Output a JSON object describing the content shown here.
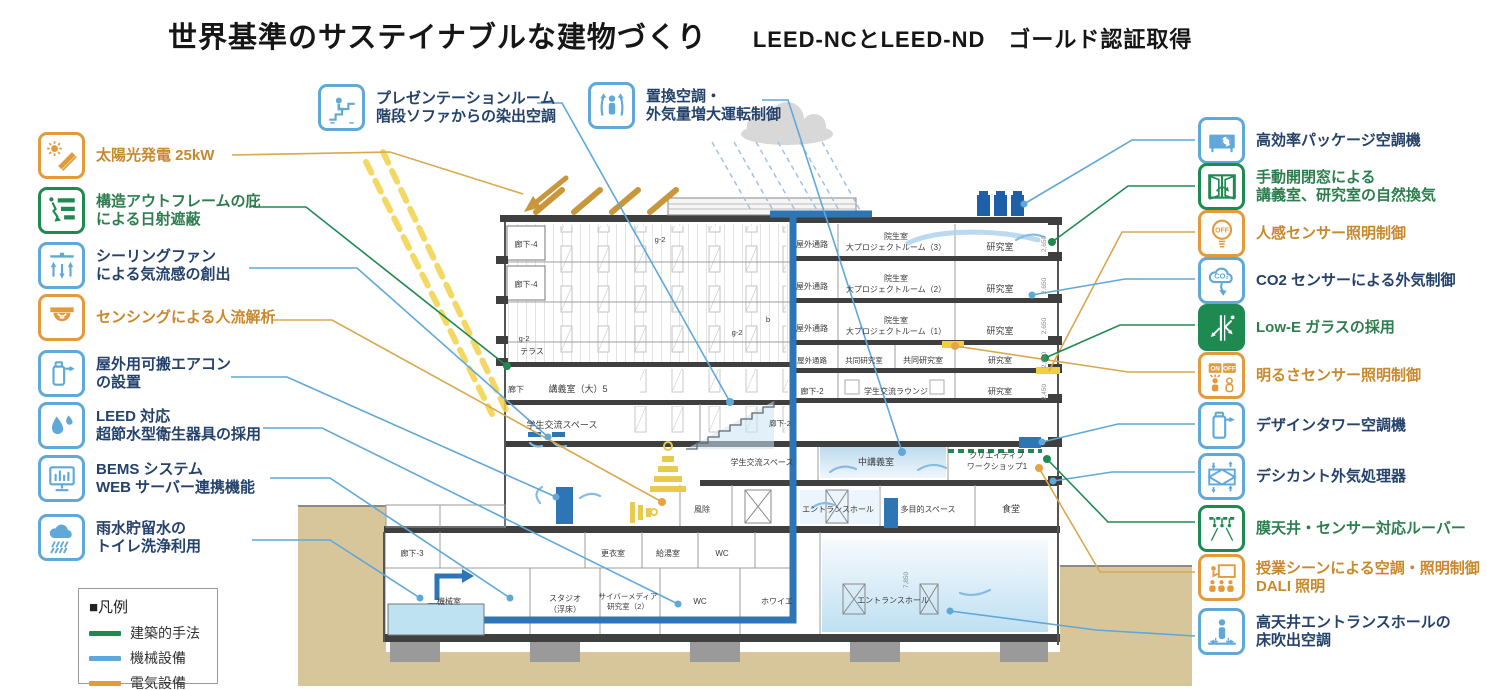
{
  "title": {
    "main": "世界基準のサステイナブルな建物づくり",
    "sub": "LEED-NCとLEED-ND　ゴールド認証取得"
  },
  "legend": {
    "title": "■凡例",
    "items": [
      {
        "label": "建築的手法",
        "color": "#1E8A52"
      },
      {
        "label": "機械設備",
        "color": "#5FA8D8"
      },
      {
        "label": "電気設備",
        "color": "#E39A3B"
      }
    ]
  },
  "colors": {
    "architectural": "#1E8A52",
    "mechanical": "#5FA8D8",
    "electrical": "#E39A3B",
    "text_navy": "#24426B",
    "text_green": "#2E7D4F",
    "text_orange": "#C8882C",
    "pipe": "#2E75B6",
    "ground": "#D8C69B",
    "sun_ray": "#F2D348"
  },
  "icon_glyphs": {
    "on": "ON",
    "off": "OFF",
    "co2": "CO₂"
  },
  "top_items": [
    {
      "label_l1": "プレゼンテーションルーム",
      "label_l2": "階段ソファからの染出空調",
      "category": "機械設備",
      "icon": "stair-sofa-icon"
    },
    {
      "label_l1": "置換空調・",
      "label_l2": "外気量増大運転制御",
      "category": "機械設備",
      "icon": "displacement-vent-icon"
    }
  ],
  "left_items": [
    {
      "label_l1": "太陽光発電 25kW",
      "category": "電気設備",
      "icon": "solar-panel-icon"
    },
    {
      "label_l1": "構造アウトフレームの庇",
      "label_l2": "による日射遮蔽",
      "category": "建築的手法",
      "icon": "eaves-shading-icon"
    },
    {
      "label_l1": "シーリングファン",
      "label_l2": "による気流感の創出",
      "category": "機械設備",
      "icon": "ceiling-fan-icon"
    },
    {
      "label_l1": "センシングによる人流解析",
      "category": "電気設備",
      "icon": "sensor-dome-icon"
    },
    {
      "label_l1": "屋外用可搬エアコン",
      "label_l2": "の設置",
      "category": "機械設備",
      "icon": "portable-ac-icon"
    },
    {
      "label_l1": "LEED 対応",
      "label_l2": "超節水型衛生器具の採用",
      "category": "機械設備",
      "icon": "water-drop-icon"
    },
    {
      "label_l1": "BEMS システム",
      "label_l2": "WEB サーバー連携機能",
      "category": "機械設備",
      "icon": "bems-monitor-icon"
    },
    {
      "label_l1": "雨水貯留水の",
      "label_l2": "トイレ洗浄利用",
      "category": "機械設備",
      "icon": "rain-cloud-icon"
    }
  ],
  "right_items": [
    {
      "label_l1": "高効率パッケージ空調機",
      "category": "機械設備",
      "icon": "package-ac-icon"
    },
    {
      "label_l1": "手動開閉窓による",
      "label_l2": "講義室、研究室の自然換気",
      "category": "建築的手法",
      "icon": "window-vent-icon"
    },
    {
      "label_l1": "人感センサー照明制御",
      "category": "電気設備",
      "icon": "motion-sensor-bulb-icon"
    },
    {
      "label_l1": "CO2 センサーによる外気制御",
      "category": "機械設備",
      "icon": "co2-sensor-icon"
    },
    {
      "label_l1": "Low-E ガラスの採用",
      "category": "建築的手法",
      "icon": "low-e-glass-icon"
    },
    {
      "label_l1": "明るさセンサー照明制御",
      "category": "電気設備",
      "icon": "brightness-sensor-icon"
    },
    {
      "label_l1": "デザインタワー空調機",
      "category": "機械設備",
      "icon": "design-tower-icon"
    },
    {
      "label_l1": "デシカント外気処理器",
      "category": "機械設備",
      "icon": "desiccant-icon"
    },
    {
      "label_l1": "膜天井・センサー対応ルーバー",
      "category": "建築的手法",
      "icon": "membrane-ceiling-icon"
    },
    {
      "label_l1": "授業シーンによる空調・照明制御",
      "label_l2": "DALI 照明",
      "category": "電気設備",
      "icon": "dali-lighting-icon"
    },
    {
      "label_l1": "高天井エントランスホールの",
      "label_l2": "床吹出空調",
      "category": "機械設備",
      "icon": "floor-supply-icon"
    }
  ],
  "building": {
    "rooms": {
      "rouka4": "廊下-4",
      "terrace": "テラス",
      "g2": "g-2",
      "b": "b",
      "lecture_large": "講義室（大）5",
      "rouka": "廊下",
      "exchange_space": "学生交流スペース",
      "outdoor_path": "屋外通路",
      "insei": "院生室",
      "proj3": "大プロジェクトルーム（3）",
      "proj2": "大プロジェクトルーム（2）",
      "proj1": "大プロジェクトルーム（1）",
      "kenkyu": "研究室",
      "kyodo": "共同研究室",
      "rouka2": "廊下-2",
      "lounge": "学生交流ラウンジ",
      "chu_lecture": "中講義室",
      "workshop_l1": "クリエイティブ",
      "workshop_l2": "ワークショップ1",
      "fujo": "風除",
      "entrance_hall": "エントランスホール",
      "tamokuteki": "多目的スペース",
      "shokudo": "食堂",
      "rouka3": "廊下-3",
      "koui": "更衣室",
      "kyuto": "給湯室",
      "wc": "WC",
      "kikai": "機械室",
      "studio_l1": "スタジオ",
      "studio_l2": "（浮床）",
      "cyber_l1": "サイバーメディア",
      "cyber_l2": "研究室（2）",
      "foyer": "ホワイエ"
    },
    "dims": [
      "2,650",
      "2,450",
      "7,850"
    ]
  }
}
